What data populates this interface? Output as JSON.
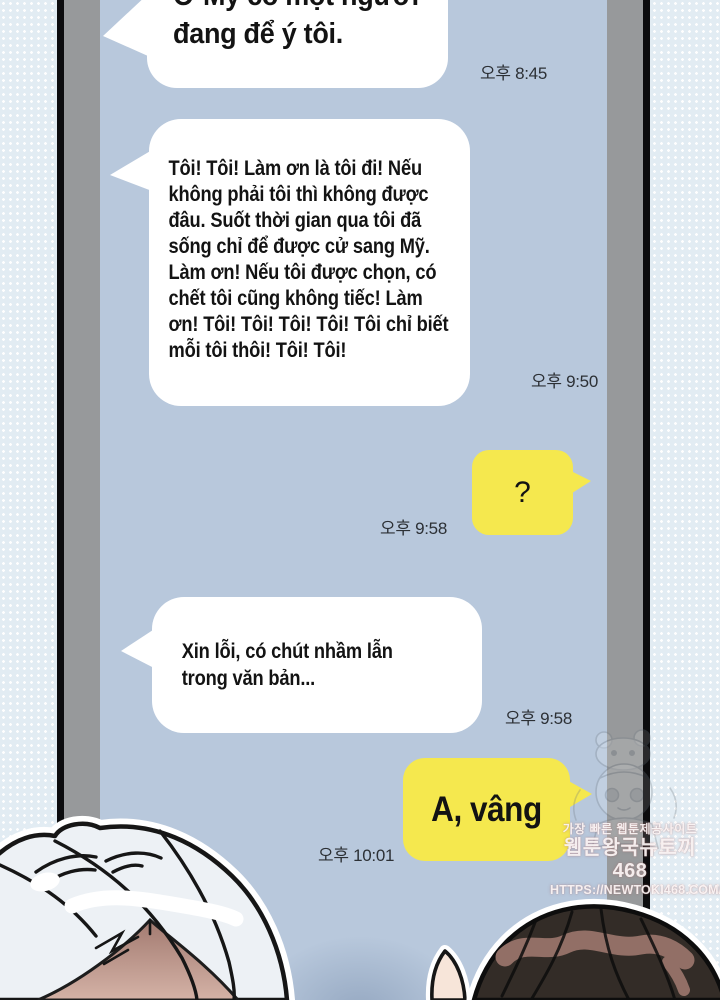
{
  "panel": {
    "type": "webtoon-chat-panel"
  },
  "conversation": {
    "messages": [
      {
        "side": "left",
        "lines": [
          "Ở Mỹ có một người",
          "đang để ý tôi."
        ],
        "time": "오후 8:45"
      },
      {
        "side": "left",
        "lines": [
          "Tôi! Tôi! Làm ơn là tôi đi! Nếu",
          "không phải tôi thì không được",
          "đâu. Suốt thời gian qua tôi đã",
          "sống chỉ để được cử sang Mỹ.",
          "Làm ơn! Nếu tôi được chọn, có",
          "chết tôi cũng không tiếc! Làm",
          "ơn! Tôi! Tôi! Tôi! Tôi! Tôi chỉ biết",
          "mỗi tôi thôi! Tôi! Tôi!"
        ],
        "time": "오후 9:50"
      },
      {
        "side": "right",
        "lines": [
          "?"
        ],
        "time": "오후 9:58"
      },
      {
        "side": "left",
        "lines": [
          "Xin lỗi, có chút nhầm lẫn",
          "trong văn bản..."
        ],
        "time": "오후 9:58"
      },
      {
        "side": "right",
        "lines": [
          "A, vâng"
        ],
        "time": "오후 10:01"
      }
    ]
  },
  "watermark": {
    "line1": "가장 빠른 웹툰제공사이트",
    "line2": "웹툰왕국뉴토끼468",
    "line3": "HTTPS://NEWTOKI468.COM/"
  },
  "colors": {
    "screen_blue": "#b8c8dc",
    "bubble_white": "#ffffff",
    "bubble_yellow": "#f5e84e",
    "bezel_gray": "#97999b",
    "frame_black": "#0c0c0e",
    "backdrop": "#e2ecf3",
    "text": "#131313",
    "timestamp": "#2c3035"
  }
}
